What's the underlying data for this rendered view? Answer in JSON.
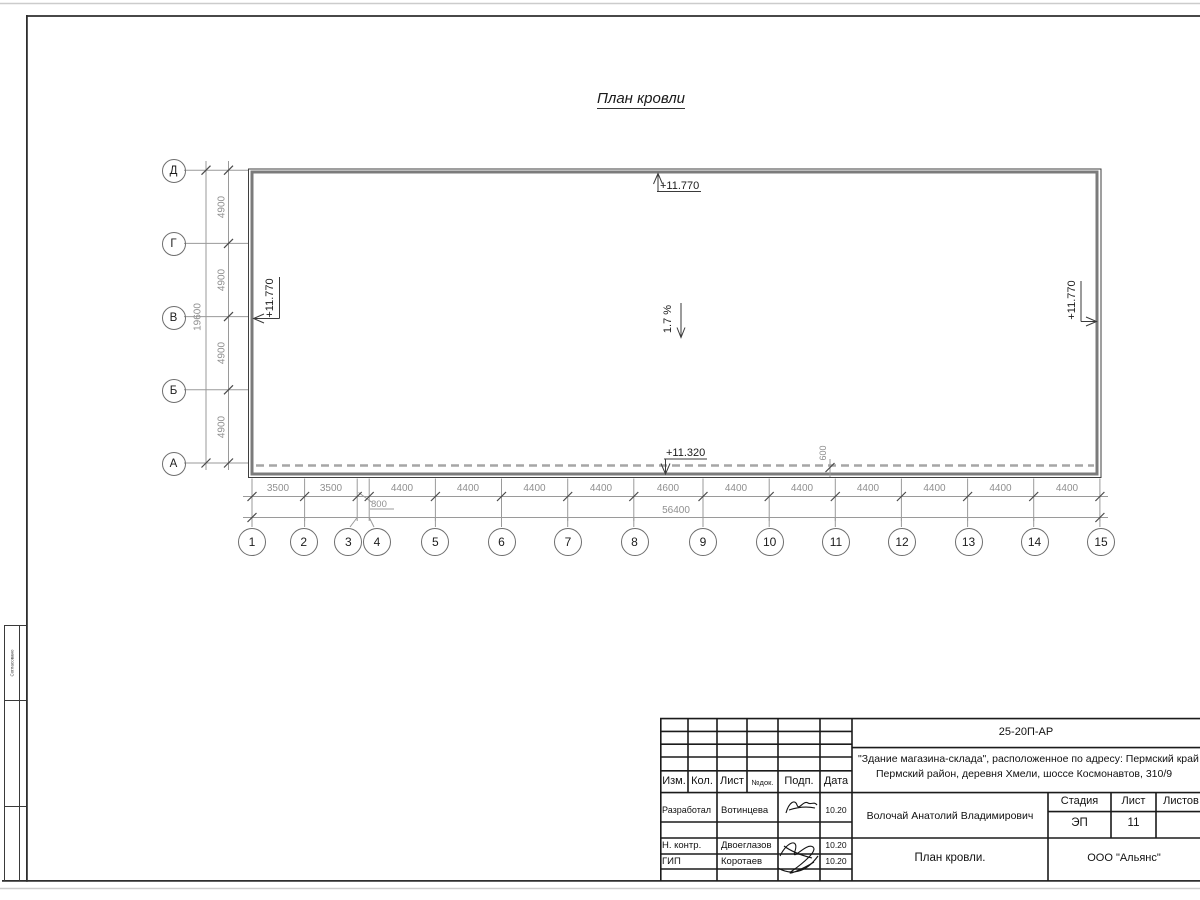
{
  "drawing_title": "План кровли",
  "grid": {
    "row_axes": [
      "Д",
      "Г",
      "В",
      "Б",
      "А"
    ],
    "col_axes": [
      "1",
      "2",
      "3",
      "4",
      "5",
      "6",
      "7",
      "8",
      "9",
      "10",
      "11",
      "12",
      "13",
      "14",
      "15"
    ],
    "row_spans": [
      "4900",
      "4900",
      "4900",
      "4900"
    ],
    "row_total": "19600",
    "col_spans": [
      "3500",
      "3500",
      "800",
      "4400",
      "4400",
      "4400",
      "4400",
      "4600",
      "4400",
      "4400",
      "4400",
      "4400",
      "4400",
      "4400"
    ],
    "col_total": "56400",
    "edge_offset": "600"
  },
  "marks": {
    "elev_top": "+11.770",
    "elev_left": "+11.770",
    "elev_right": "+11.770",
    "elev_eave": "+11.320",
    "slope": "1.7 %"
  },
  "side_stamp": {
    "label": "Согласовано"
  },
  "title_block": {
    "doc_number": "25-20П-АР",
    "project_line1": "\"Здание магазина-склада\", расположенное по адресу: Пермский край",
    "project_line2": "Пермский район, деревня Хмели, шоссе Космонавтов, 310/9",
    "header": [
      "Изм.",
      "Кол.",
      "Лист",
      "№док.",
      "Подп.",
      "Дата"
    ],
    "rows": [
      {
        "role": "Разработал",
        "name": "Вотинцева",
        "date": "10.20"
      },
      {
        "role": "Н. контр.",
        "name": "Двоеглазов",
        "date": "10.20"
      },
      {
        "role": "ГИП",
        "name": "Коротаев",
        "date": "10.20"
      }
    ],
    "chief": "Волочай Анатолий Владимирович",
    "stage_label": "Стадия",
    "sheet_label": "Лист",
    "sheets_label": "Листов",
    "stage": "ЭП",
    "sheet": "11",
    "sheet_title": "План кровли.",
    "company": "ООО \"Альянс\""
  }
}
